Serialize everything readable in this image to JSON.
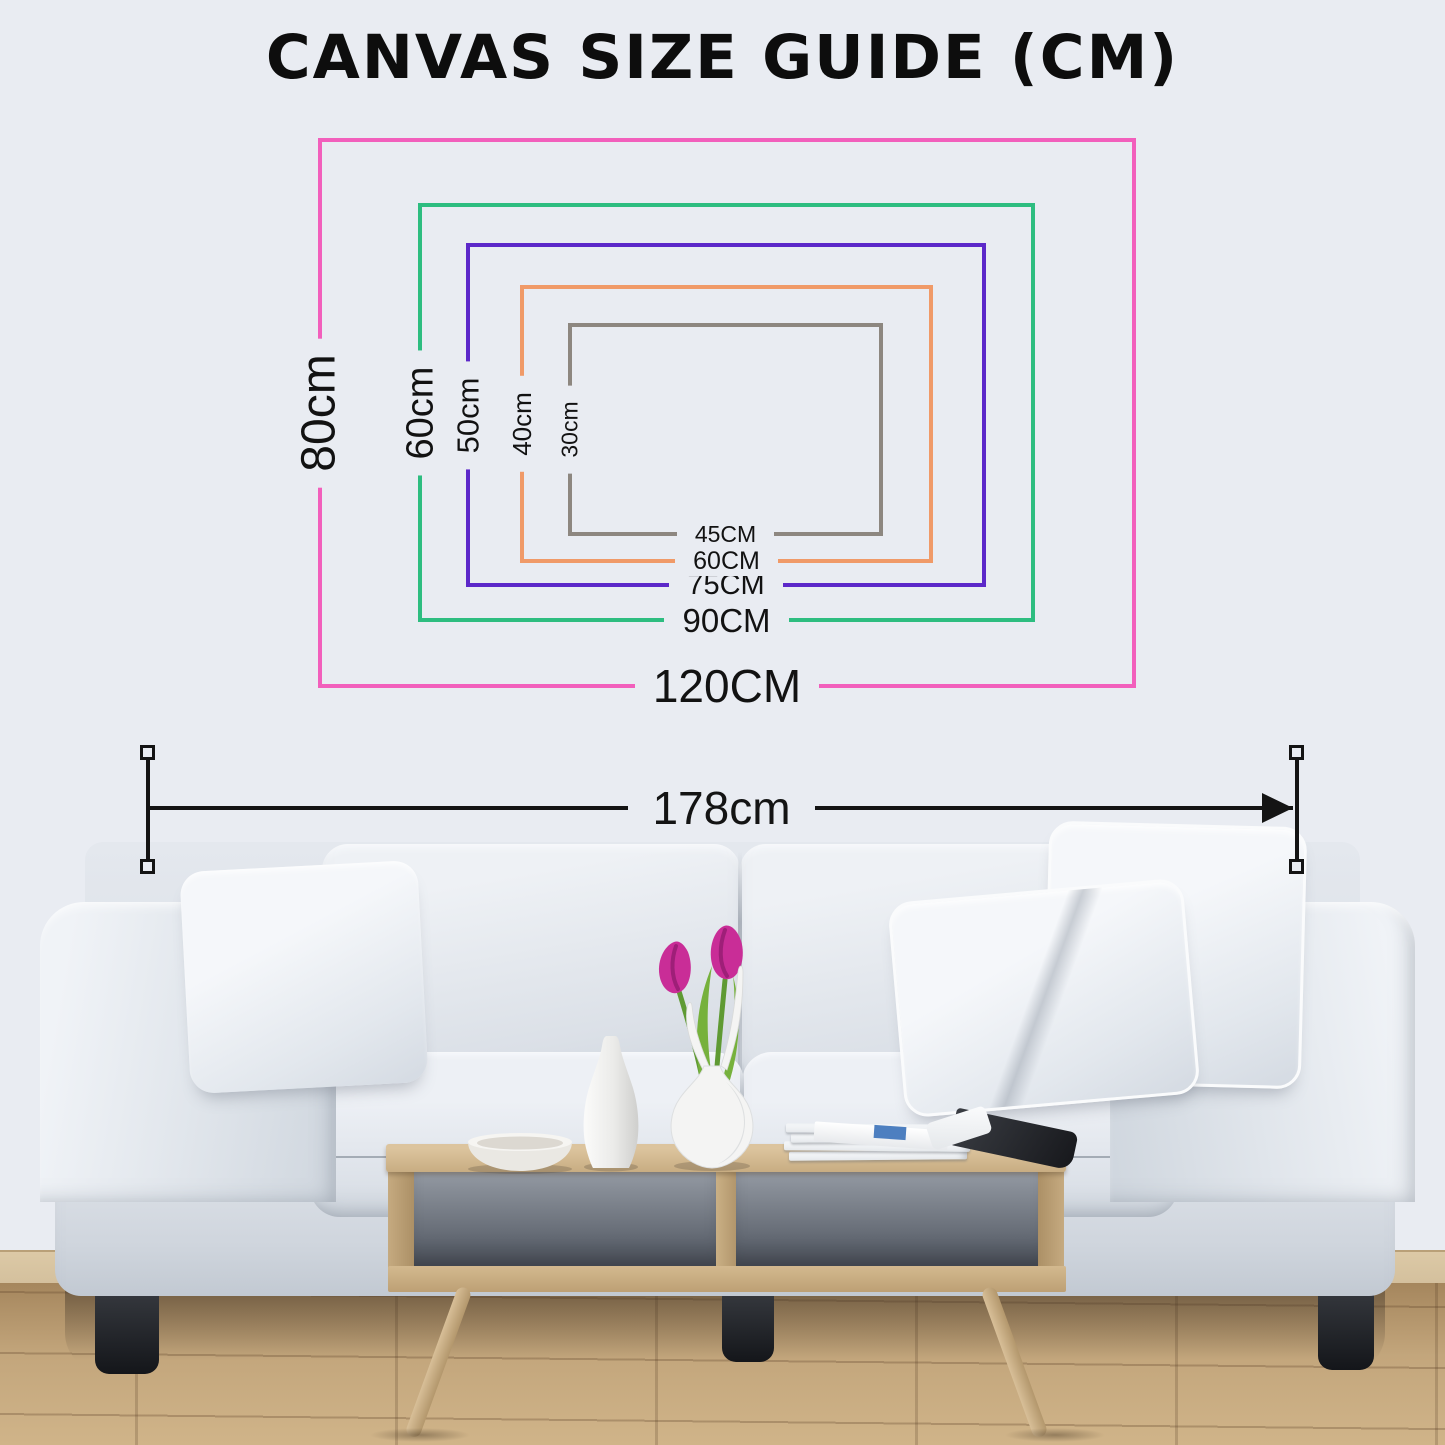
{
  "title": "CANVAS SIZE GUIDE (CM)",
  "diagram": {
    "rectangles": [
      {
        "name": "canvas-120x80",
        "width_label": "120CM",
        "height_label": "80cm",
        "color": "#f25fbc"
      },
      {
        "name": "canvas-90x60",
        "width_label": "90CM",
        "height_label": "60cm",
        "color": "#2dbd80"
      },
      {
        "name": "canvas-75x50",
        "width_label": "75CM",
        "height_label": "50cm",
        "color": "#5c28c9"
      },
      {
        "name": "canvas-60x40",
        "width_label": "60CM",
        "height_label": "40cm",
        "color": "#f09a68"
      },
      {
        "name": "canvas-45x30",
        "width_label": "45CM",
        "height_label": "30cm",
        "color": "#8d8780"
      }
    ]
  },
  "measurement": {
    "label": "178cm",
    "color": "#141414"
  },
  "scene": {
    "wall_color": "#e9ecf2",
    "floor_color": "#c3a67c",
    "baseboard_color": "#d3bf9c",
    "sofa_fabric_color": "#e6eaef",
    "sofa_leg_color": "#26282d",
    "table_wood_color": "#cdb38c",
    "tulip_color": "#c92d97",
    "leaf_color": "#76b13c",
    "vase_color": "#f4f4f3"
  }
}
